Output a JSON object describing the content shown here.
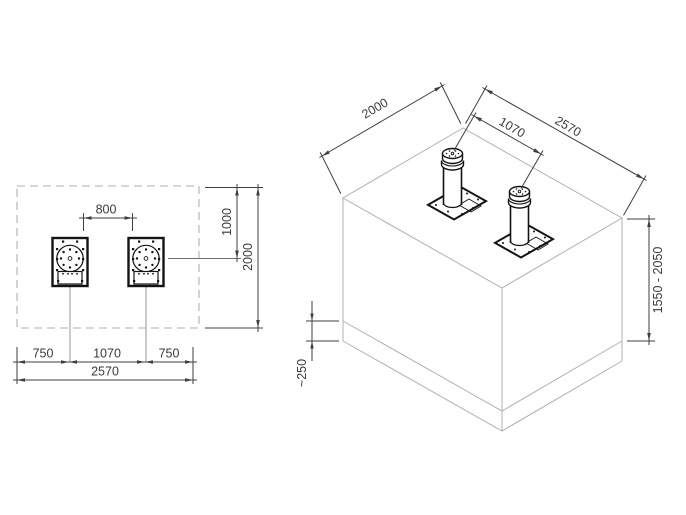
{
  "title": "Automatic bollard foundation installation drawing",
  "colors": {
    "background": "#ffffff",
    "dimension_lines": "#3f3f3f",
    "object_lines": "#141414",
    "construction_lines": "#b0b0b0",
    "centerlines": "#8c8c8c"
  },
  "plan_view": {
    "name": "top view of foundation pit with two bollard flanges",
    "dimensions": {
      "bollard_clear_spacing": "800",
      "edge_to_bollard_axis": "1000",
      "pit_depth": "2000",
      "left_margin": "750",
      "bollard_center_spacing": "1070",
      "right_margin": "750",
      "pit_width": "2570"
    }
  },
  "isometric_view": {
    "name": "isometric view of concrete foundation block with two bollards",
    "dimensions": {
      "pit_depth": "2000",
      "bollard_center_spacing": "1070",
      "pit_width": "2570",
      "pit_height_range": "1550 - 2050",
      "base_layer_thickness": "~250"
    }
  }
}
